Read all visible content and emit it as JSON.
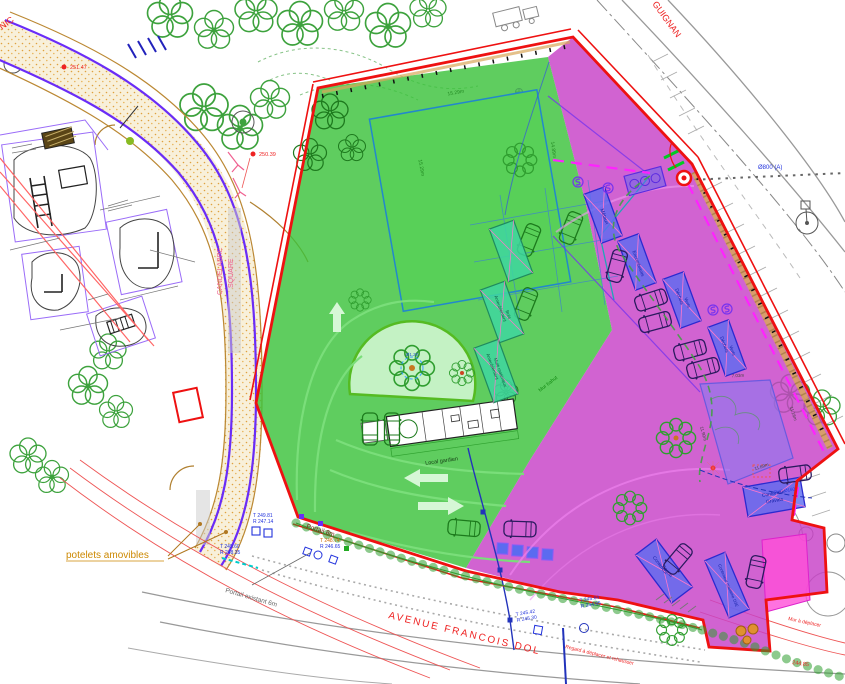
{
  "plan": {
    "streets": {
      "avenue": "AVENUE FRANCOIS DOL",
      "rue_partial": "GUIGNAN",
      "rue_partial_left": "NIC"
    },
    "path": {
      "candelabre": "CANDELABRE",
      "square": "SQUARE"
    },
    "notes": {
      "potelets": "potelets amovibles",
      "portail_existant": "Portail existant 6m",
      "portail_8m": "Portail 8m",
      "regard": "Regard à déplacer et rehausser",
      "mur_deplacer": "Mur à déplacer",
      "mur_bahut": "Mur bahut",
      "local_gardien": "Local gardien"
    },
    "levels": {
      "pt1": "251.47",
      "pt2": "250.39",
      "pt3": "244.85"
    },
    "network": {
      "p1t": "T 249.81",
      "p1r": "R 247.14",
      "p2t": "T 249.60",
      "p2r": "R 248.35",
      "p3t": "T 248.74",
      "p3r": "R 246.65",
      "p4t": "T 245.42",
      "p4r": "R 245.30",
      "p5t": "T 245.64",
      "p5r": "R 244.95",
      "d800": "Ø800 (A)",
      "pvc": "PVC Ø160"
    },
    "containers": {
      "metaux": "Métaux",
      "encombrants": "Encombrants",
      "dv1a": "Déchets",
      "dv1b": "Verts",
      "dv2a": "Déchets",
      "dv2b": "Verts",
      "gravats1": "Conteneur",
      "gravats2": "Gravats",
      "carton1": "Conteneur",
      "carton2": "Carton",
      "d3e": "Conteneur maritime D3E",
      "bois1": "Ameublement",
      "bois2": "Bois",
      "mm1": "Ameublement",
      "mm2": "Multi matériaux"
    },
    "dimensions": {
      "rect_top": "15.29m",
      "rect_left": "15.29m",
      "rect_right": "14.89m",
      "quad_top": "7.03m",
      "quad_left": "11.90m",
      "quad_right": "11.16m",
      "quad_bottom": "11.69m",
      "tree_ring": "Ø1.20"
    },
    "colors": {
      "green_zone": "#3cc23c",
      "magenta_zone": "#c741c7",
      "boundary": "#ee1111",
      "violet_zone": "#8a7af0",
      "pink_zone": "#ff4fd8"
    }
  }
}
